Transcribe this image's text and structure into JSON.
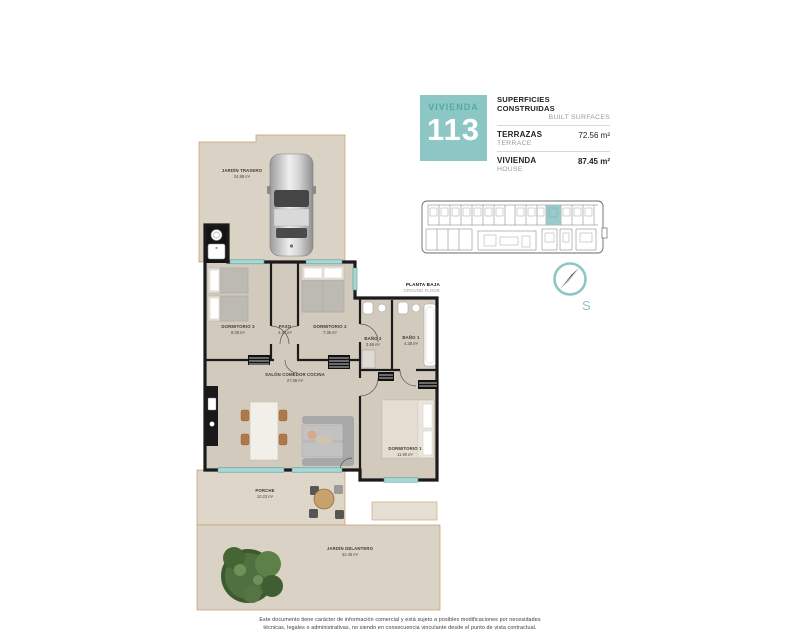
{
  "theme": {
    "teal": "#8cc7c5",
    "teal_dark": "#55a7a5",
    "teal_light": "#a8d8d6",
    "wall": "#1b1b1b",
    "floor": "#d2cabd",
    "garden": "#d9d2c5",
    "outline": "#c69c6d",
    "label": "#3e3a33"
  },
  "header": {
    "unit_label": "VIVIENDA",
    "unit_number": "113",
    "surfaces_title_es": "SUPERFICIES CONSTRUIDAS",
    "surfaces_title_en": "BUILT SURFACES",
    "rows": [
      {
        "label_es": "TERRAZAS",
        "label_en": "TERRACE",
        "value": "72.56 m²"
      },
      {
        "label_es": "VIVIENDA",
        "label_en": "HOUSE",
        "value": "87.45 m²"
      }
    ]
  },
  "floor_label": {
    "es": "PLANTA BAJA",
    "en": "GROUND FLOOR"
  },
  "compass": {
    "label": "S"
  },
  "rooms": {
    "jardin_trasero": {
      "name": "JARDÍN TRASERO",
      "area": "24.88 m²"
    },
    "dormitorio3": {
      "name": "DORMITORIO 3",
      "area": "8.08 m²"
    },
    "paso": {
      "name": "PASO",
      "area": "4.44 m²"
    },
    "dormitorio2": {
      "name": "DORMITORIO 2",
      "area": "7.36 m²"
    },
    "bano2": {
      "name": "BAÑO 2",
      "area": "3.55 m²"
    },
    "bano1": {
      "name": "BAÑO 1",
      "area": "4.38 m²"
    },
    "salon": {
      "name": "SALÓN COMEDOR COCINA",
      "area": "27.08 m²"
    },
    "dormitorio1": {
      "name": "DORMITORIO 1",
      "area": "11.90 m²"
    },
    "porche": {
      "name": "PORCHE",
      "area": "10.23 m²"
    },
    "jardin_delantero": {
      "name": "JARDÍN DELANTERO",
      "area": "32.46 m²"
    }
  },
  "disclaimer": {
    "line1": "Este documento tiene carácter de información comercial y está sujeto a posibles modificaciones por necesidades",
    "line2": "técnicas, legales o administrativas, no siendo en consecuencia vinculante desde el punto de vista contractual."
  }
}
